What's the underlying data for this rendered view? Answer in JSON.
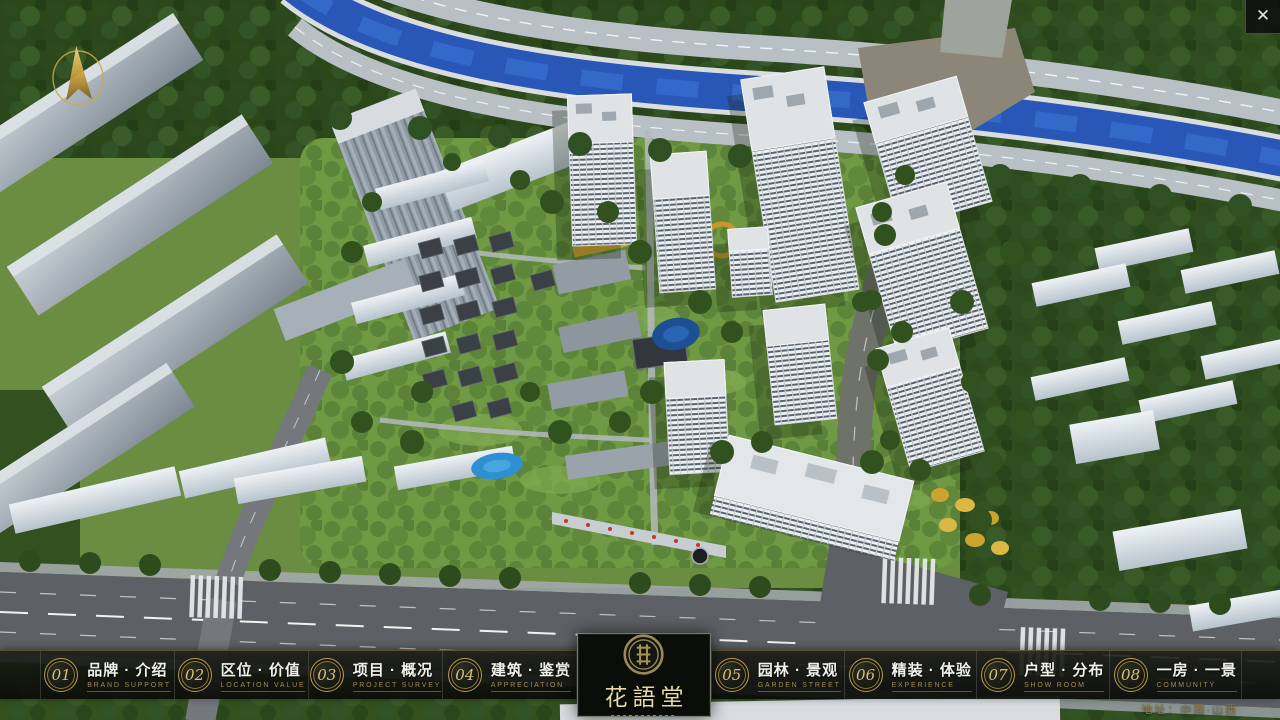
{
  "window": {
    "close_icon": "✕"
  },
  "nav": {
    "items": [
      {
        "num": "01",
        "zh": "品牌 · 介绍",
        "en": "BRAND SUPPORT"
      },
      {
        "num": "02",
        "zh": "区位 · 价值",
        "en": "LOCATION VALUE"
      },
      {
        "num": "03",
        "zh": "项目 · 概况",
        "en": "PROJECT SURVEY"
      },
      {
        "num": "04",
        "zh": "建筑 · 鉴赏",
        "en": "APPRECIATION"
      },
      {
        "num": "05",
        "zh": "园林 · 景观",
        "en": "GARDEN STREET"
      },
      {
        "num": "06",
        "zh": "精装 · 体验",
        "en": "EXPERIENCE"
      },
      {
        "num": "07",
        "zh": "户型 · 分布",
        "en": "SHOW ROOM"
      },
      {
        "num": "08",
        "zh": "一房 · 一景",
        "en": "COMMUNITY"
      }
    ],
    "logo_title": "花語堂",
    "address": "地址：中国·山西"
  },
  "colors": {
    "accent_gold": "#b49a55",
    "number_gold": "#d8c07a",
    "nav_text": "#f1f1ec",
    "nav_subtext": "#a28c52",
    "logo_gold": "#e7d9a6",
    "address_gold": "#8a7a4a",
    "nav_bg": "#10120c",
    "river_blue": "#2857b8",
    "lawn_green": "#6a8d41",
    "tree_green": "#2c481b",
    "road_gray": "#5d6165",
    "building_white": "#e9edf0",
    "slab_gray": "#97a2ac",
    "compass_gold": "#d8b35c"
  }
}
